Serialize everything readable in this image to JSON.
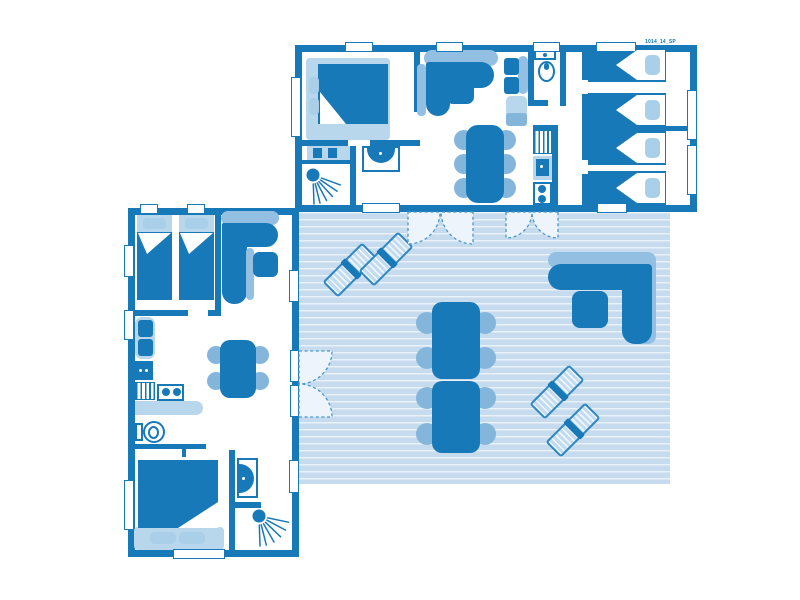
{
  "plan": {
    "ref_label": "1014_14_SP",
    "units": {
      "top_cottage": {
        "name": "cottage-a",
        "rooms": [
          "master-bedroom",
          "wardrobe-nook",
          "shower-room",
          "washbasin-room",
          "living-room",
          "wc",
          "kitchen",
          "twin-bedroom-1",
          "twin-bedroom-2"
        ],
        "furniture": [
          "double-bed",
          "corner-sofa",
          "coffee-table",
          "dining-table",
          "dining-chairs-x6",
          "bench-seat",
          "cabinet",
          "toilet",
          "kitchen-sink",
          "hob-2-burners",
          "worktop",
          "single-beds-x4",
          "washbasin",
          "shower"
        ]
      },
      "left_cottage": {
        "name": "cottage-b",
        "rooms": [
          "twin-bedroom",
          "living-kitchen",
          "wc",
          "double-bedroom",
          "washbasin-area",
          "shower-room"
        ],
        "furniture": [
          "single-beds-x2",
          "corner-sofa",
          "coffee-table",
          "dining-table",
          "dining-chairs-x4",
          "bench-seat",
          "fridge",
          "hob-2-burners",
          "worktop",
          "toilet",
          "double-bed",
          "washbasin",
          "shower"
        ]
      },
      "terrace": {
        "name": "shared-terrace-deck",
        "furniture": [
          "sun-loungers-x4",
          "outdoor-dining-table",
          "outdoor-chairs-x8",
          "outdoor-corner-sofa",
          "outdoor-coffee-table"
        ],
        "doors": [
          "french-doors-cottage-a-left",
          "french-doors-cottage-a-right",
          "french-doors-cottage-b"
        ]
      }
    }
  },
  "colors": {
    "ink": "#1879b9",
    "cushion": "#84b6dc",
    "backrest": "#93c0e2",
    "pillow": "#a9cfe9",
    "base": "#b9d7ec",
    "deck": "#c6dbee",
    "deck_line": "#e9f1f9",
    "swing": "#edf4fb",
    "arc": "#4a97cc",
    "stripe_light": "#eef5fb",
    "stripe_blue": "#c2dbef",
    "page_bg": "#ffffff"
  }
}
